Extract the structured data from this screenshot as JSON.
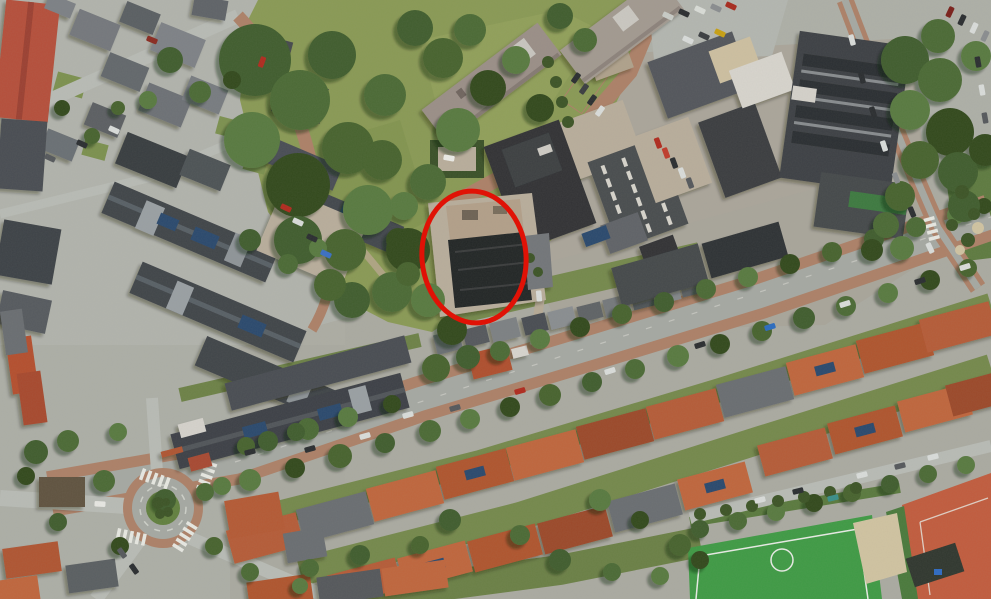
{
  "scene": {
    "type": "satellite-aerial-photo",
    "width": 991,
    "height": 599,
    "description": "Aerial satellite view of a Dutch neighbourhood: park with apartment blocks at top, industrial yard at top right, tree-lined diagonal avenue, rows of red-roofed houses at bottom, roundabout at bottom left, sports field and clay courts at bottom right. One industrial building is circled in red."
  },
  "annotation": {
    "name": "highlight-ellipse",
    "shape": "ellipse",
    "cx": 474,
    "cy": 257,
    "rx": 52,
    "ry": 66,
    "rotation_deg": -5,
    "stroke_color": "#e01206",
    "stroke_width": 5
  },
  "palette": {
    "base": "#aeb0a8",
    "road_asphalt": "#a6a9a3",
    "road_light": "#b9bcb6",
    "road_brick": "#ad8168",
    "lawn": "#8a9a55",
    "lawn_light": "#9aa862",
    "garden_green": "#75894c",
    "hedge_dark": "#3c5426",
    "tree_shades": [
      "#3f5d2d",
      "#4c6b36",
      "#587a40",
      "#33491f",
      "#46632f"
    ],
    "roof_red": "#b65b37",
    "roof_red_dark": "#9c4a2c",
    "roof_red_light": "#c0663e",
    "roof_dark": "#3d4146",
    "industrial_dark": "#303336",
    "white_roof": "#d8d5ce",
    "tan_roof": "#cec0a1",
    "apartment_roof": "#9b8f88",
    "solar": "#2c4a6e",
    "field_green": "#3f9b45",
    "clay": "#c25c3e",
    "sand": "#d1c4a2",
    "gravel": "#b9ae9c",
    "roundabout_green": "#62803f"
  },
  "objects": {
    "trees": {
      "park-trees": [
        [
          255,
          60,
          36
        ],
        [
          300,
          100,
          30
        ],
        [
          252,
          140,
          28
        ],
        [
          298,
          185,
          32
        ],
        [
          348,
          148,
          26
        ],
        [
          332,
          55,
          24
        ],
        [
          385,
          95,
          21
        ],
        [
          368,
          210,
          25
        ],
        [
          408,
          250,
          22
        ],
        [
          345,
          250,
          21
        ],
        [
          298,
          240,
          24
        ],
        [
          428,
          182,
          18
        ],
        [
          458,
          130,
          22
        ],
        [
          488,
          88,
          18
        ],
        [
          443,
          58,
          20
        ],
        [
          415,
          28,
          18
        ],
        [
          470,
          30,
          16
        ],
        [
          516,
          60,
          14
        ],
        [
          540,
          108,
          14
        ],
        [
          382,
          160,
          20
        ],
        [
          352,
          300,
          18
        ],
        [
          392,
          292,
          20
        ],
        [
          428,
          300,
          17
        ],
        [
          452,
          330,
          15
        ],
        [
          330,
          285,
          16
        ],
        [
          560,
          16,
          13
        ],
        [
          585,
          40,
          12
        ],
        [
          404,
          206,
          14
        ],
        [
          398,
          240,
          12
        ],
        [
          408,
          274,
          12
        ]
      ],
      "avenue-trees-south": [
        [
          165,
          500,
          11
        ],
        [
          205,
          492,
          9
        ],
        [
          250,
          480,
          11
        ],
        [
          295,
          468,
          10
        ],
        [
          340,
          456,
          12
        ],
        [
          385,
          443,
          10
        ],
        [
          430,
          431,
          11
        ],
        [
          470,
          419,
          10
        ],
        [
          510,
          407,
          10
        ],
        [
          550,
          395,
          11
        ],
        [
          592,
          382,
          10
        ],
        [
          635,
          369,
          10
        ],
        [
          678,
          356,
          11
        ],
        [
          720,
          344,
          10
        ],
        [
          762,
          331,
          10
        ],
        [
          804,
          318,
          11
        ],
        [
          846,
          306,
          10
        ],
        [
          888,
          293,
          10
        ],
        [
          930,
          280,
          10
        ],
        [
          968,
          268,
          9
        ]
      ],
      "avenue-trees-north": [
        [
          268,
          441,
          10
        ],
        [
          308,
          429,
          11
        ],
        [
          348,
          417,
          10
        ],
        [
          392,
          404,
          9
        ],
        [
          436,
          368,
          14
        ],
        [
          468,
          357,
          12
        ],
        [
          500,
          351,
          10
        ],
        [
          540,
          339,
          10
        ],
        [
          580,
          327,
          10
        ],
        [
          622,
          314,
          10
        ],
        [
          664,
          302,
          10
        ],
        [
          706,
          289,
          10
        ],
        [
          748,
          277,
          10
        ],
        [
          790,
          264,
          10
        ],
        [
          832,
          252,
          10
        ],
        [
          874,
          239,
          10
        ],
        [
          916,
          227,
          10
        ],
        [
          956,
          215,
          9
        ],
        [
          984,
          206,
          8
        ]
      ],
      "right-side-trees": [
        [
          905,
          60,
          24
        ],
        [
          940,
          80,
          22
        ],
        [
          910,
          110,
          20
        ],
        [
          950,
          132,
          24
        ],
        [
          920,
          160,
          19
        ],
        [
          958,
          172,
          20
        ],
        [
          938,
          36,
          17
        ],
        [
          976,
          56,
          15
        ],
        [
          985,
          150,
          16
        ],
        [
          900,
          196,
          15
        ],
        [
          964,
          206,
          16
        ],
        [
          886,
          225,
          13
        ],
        [
          902,
          248,
          12
        ],
        [
          872,
          250,
          11
        ]
      ],
      "misc-trees": [
        [
          170,
          60,
          13
        ],
        [
          200,
          92,
          11
        ],
        [
          148,
          100,
          9
        ],
        [
          232,
          80,
          9
        ],
        [
          92,
          136,
          8
        ],
        [
          250,
          240,
          11
        ],
        [
          288,
          264,
          10
        ],
        [
          318,
          248,
          9
        ],
        [
          62,
          108,
          8
        ],
        [
          118,
          108,
          7
        ],
        [
          36,
          452,
          12
        ],
        [
          68,
          441,
          11
        ],
        [
          118,
          432,
          9
        ],
        [
          26,
          476,
          9
        ],
        [
          246,
          446,
          9
        ],
        [
          296,
          432,
          9
        ],
        [
          104,
          481,
          11
        ],
        [
          222,
          486,
          9
        ],
        [
          120,
          546,
          9
        ],
        [
          214,
          546,
          9
        ],
        [
          58,
          522,
          9
        ],
        [
          250,
          572,
          9
        ],
        [
          300,
          586,
          8
        ]
      ],
      "bottom-trees": [
        [
          450,
          520,
          11
        ],
        [
          520,
          535,
          10
        ],
        [
          600,
          500,
          11
        ],
        [
          640,
          520,
          9
        ],
        [
          680,
          545,
          11
        ],
        [
          560,
          560,
          11
        ],
        [
          612,
          572,
          9
        ],
        [
          660,
          576,
          9
        ],
        [
          700,
          560,
          9
        ],
        [
          420,
          545,
          9
        ],
        [
          360,
          555,
          10
        ],
        [
          310,
          568,
          9
        ]
      ],
      "southeast-lane-trees": [
        [
          700,
          529,
          9
        ],
        [
          738,
          521,
          9
        ],
        [
          776,
          512,
          9
        ],
        [
          814,
          503,
          9
        ],
        [
          852,
          493,
          9
        ],
        [
          890,
          484,
          9
        ],
        [
          928,
          474,
          9
        ],
        [
          966,
          465,
          9
        ]
      ]
    },
    "bushes": [
      [
        548,
        62,
        6
      ],
      [
        556,
        82,
        6
      ],
      [
        562,
        102,
        6
      ],
      [
        568,
        122,
        6
      ],
      [
        700,
        514,
        6
      ],
      [
        726,
        510,
        6
      ],
      [
        752,
        506,
        6
      ],
      [
        778,
        501,
        6
      ],
      [
        804,
        497,
        6
      ],
      [
        830,
        492,
        6
      ],
      [
        856,
        488,
        6
      ],
      [
        158,
        503,
        6
      ],
      [
        168,
        512,
        5
      ],
      [
        160,
        514,
        5
      ],
      [
        166,
        502,
        4
      ],
      [
        962,
        192,
        7
      ],
      [
        974,
        214,
        6
      ],
      [
        968,
        240,
        7
      ],
      [
        952,
        225,
        6
      ],
      [
        530,
        258,
        5
      ],
      [
        538,
        272,
        5
      ]
    ],
    "sand_patches": [
      [
        968,
        203,
        7
      ],
      [
        978,
        228,
        6
      ],
      [
        960,
        250,
        5
      ]
    ],
    "cars": [
      [
        668,
        16,
        25,
        "#c9ccc7"
      ],
      [
        684,
        13,
        25,
        "#2a2d30"
      ],
      [
        700,
        10,
        25,
        "#daddd8"
      ],
      [
        716,
        8,
        25,
        "#8a8d90"
      ],
      [
        731,
        6,
        25,
        "#a82a1e"
      ],
      [
        688,
        40,
        25,
        "#dadddb"
      ],
      [
        704,
        36,
        25,
        "#3a3d40"
      ],
      [
        720,
        33,
        25,
        "#c8a012"
      ],
      [
        950,
        12,
        -65,
        "#7a1f1a"
      ],
      [
        962,
        20,
        -65,
        "#2a2d30"
      ],
      [
        974,
        28,
        -65,
        "#dadddb"
      ],
      [
        985,
        36,
        -65,
        "#8a8d90"
      ],
      [
        978,
        62,
        80,
        "#2a2d30"
      ],
      [
        982,
        90,
        80,
        "#dadddb"
      ],
      [
        985,
        118,
        80,
        "#55585c"
      ],
      [
        852,
        40,
        75,
        "#dadddb"
      ],
      [
        862,
        78,
        75,
        "#2a2d30"
      ],
      [
        873,
        112,
        72,
        "#2a2d30"
      ],
      [
        884,
        146,
        72,
        "#dadddb"
      ],
      [
        896,
        178,
        70,
        "#8a8d90"
      ],
      [
        912,
        212,
        68,
        "#2a2d30"
      ],
      [
        930,
        248,
        65,
        "#dadddb"
      ],
      [
        658,
        143,
        70,
        "#b02a1e"
      ],
      [
        666,
        153,
        70,
        "#c03b2b"
      ],
      [
        674,
        163,
        70,
        "#2a2d30"
      ],
      [
        682,
        173,
        70,
        "#dadddb"
      ],
      [
        690,
        183,
        70,
        "#55585c"
      ],
      [
        576,
        78,
        -55,
        "#2a2d30"
      ],
      [
        584,
        89,
        -55,
        "#3a3d40"
      ],
      [
        592,
        100,
        -55,
        "#2a2d30"
      ],
      [
        600,
        111,
        -55,
        "#dadddb"
      ],
      [
        310,
        449,
        -16,
        "#2a2d30"
      ],
      [
        365,
        436,
        -16,
        "#dadddb"
      ],
      [
        408,
        415,
        -16,
        "#dadddb"
      ],
      [
        455,
        408,
        -16,
        "#55585c"
      ],
      [
        520,
        391,
        -16,
        "#b02a1e"
      ],
      [
        610,
        371,
        -17,
        "#dadddb"
      ],
      [
        700,
        345,
        -17,
        "#2a2d30"
      ],
      [
        770,
        327,
        -17,
        "#2a6bc0"
      ],
      [
        845,
        304,
        -17,
        "#dadddb"
      ],
      [
        920,
        281,
        -17,
        "#2a2d30"
      ],
      [
        965,
        267,
        -17,
        "#dadddb"
      ],
      [
        50,
        158,
        25,
        "#55585c"
      ],
      [
        82,
        144,
        25,
        "#2a2d30"
      ],
      [
        114,
        130,
        25,
        "#dadddb"
      ],
      [
        262,
        62,
        -70,
        "#b02a1e"
      ],
      [
        152,
        40,
        22,
        "#8a2a20"
      ],
      [
        298,
        222,
        25,
        "#dadddb"
      ],
      [
        312,
        238,
        25,
        "#2a2d30"
      ],
      [
        326,
        254,
        25,
        "#3a6fc4"
      ],
      [
        286,
        208,
        25,
        "#b02a1e"
      ],
      [
        100,
        504,
        3,
        "#e8e8e4"
      ],
      [
        134,
        569,
        55,
        "#2a2d30"
      ],
      [
        122,
        553,
        55,
        "#55585c"
      ],
      [
        250,
        452,
        -14,
        "#2a2d30"
      ],
      [
        539,
        296,
        85,
        "#dadddb"
      ],
      [
        449,
        158,
        10,
        "#ecece8"
      ],
      [
        760,
        500,
        -14,
        "#dadddb"
      ],
      [
        798,
        491,
        -14,
        "#2a2d30"
      ],
      [
        833,
        498,
        -14,
        "#3a8f8a"
      ],
      [
        862,
        475,
        -14,
        "#dadddb"
      ],
      [
        900,
        466,
        -14,
        "#55585c"
      ],
      [
        933,
        457,
        -14,
        "#dadddb"
      ]
    ]
  }
}
